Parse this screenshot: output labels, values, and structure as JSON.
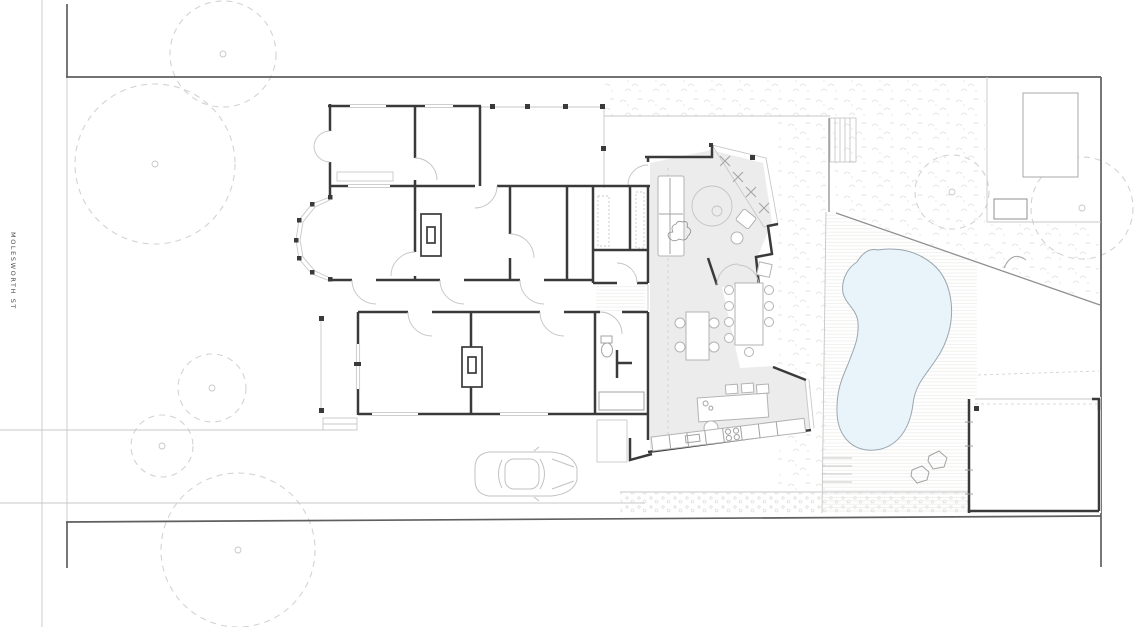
{
  "street_label": "MOLESWORTH ST",
  "plan": {
    "kind": "architectural ground-floor site plan",
    "features": [
      "street",
      "site-boundary",
      "front-garden-trees",
      "existing-house",
      "bay-window",
      "fireplaces",
      "verandah-deck",
      "rear-extension",
      "living-area",
      "dining-table",
      "kitchen-island",
      "kitchen-bench",
      "courtyard-garden",
      "pool-deck",
      "pool",
      "garden-stairs",
      "diagonal-fence",
      "lawn",
      "shed",
      "garage",
      "car",
      "pebble-strip"
    ]
  },
  "colors": {
    "background": "#ffffff",
    "walls": "#3a3a3a",
    "boundary": "#5f5f5f",
    "light_lines": "#c7c7c7",
    "floor_gray": "#ececec",
    "pool_fill": "#e9f3fa",
    "pool_outline": "#9aa7b0",
    "tree_dash": "#d3d3d3"
  }
}
